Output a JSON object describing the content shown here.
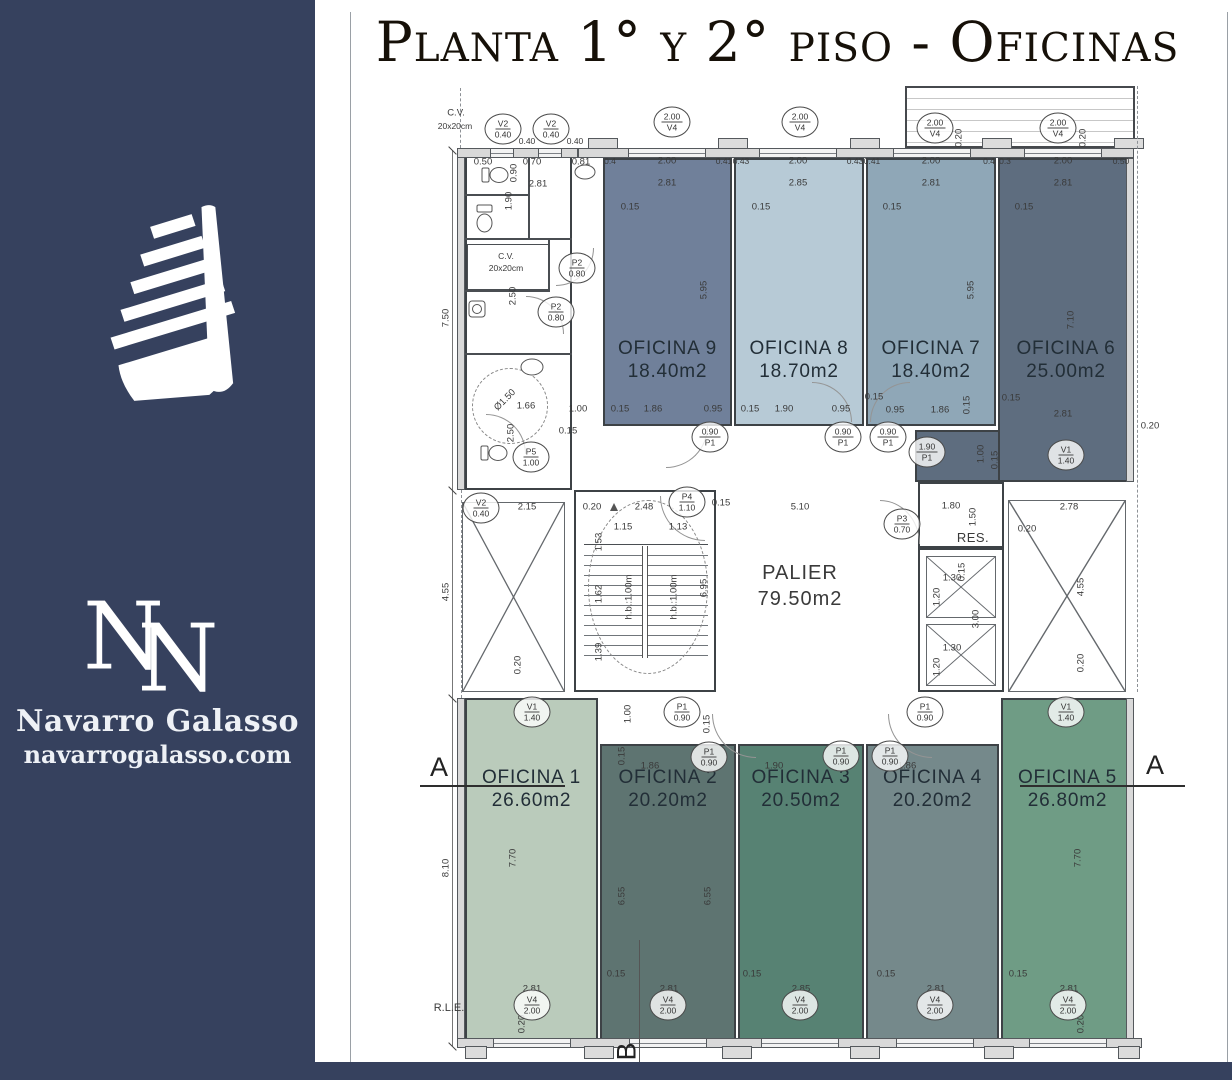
{
  "sidebar": {
    "brand": "Navarro Galasso",
    "site": "navarrogalasso.com",
    "monogram_n1": "N",
    "monogram_n2": "N",
    "bg_color": "#36415e"
  },
  "title": "Planta 1° y 2° piso - Oficinas",
  "plan": {
    "palier": {
      "name": "PALIER",
      "area": "79.50m2"
    },
    "res_label": "RES.",
    "markers": {
      "a": "A",
      "b": "B"
    },
    "offices": [
      {
        "id": 1,
        "name": "OFICINA 1",
        "area": "26.60m2",
        "color": "#bacbbb"
      },
      {
        "id": 2,
        "name": "OFICINA 2",
        "area": "20.20m2",
        "color": "#5e7471"
      },
      {
        "id": 3,
        "name": "OFICINA 3",
        "area": "20.50m2",
        "color": "#578273"
      },
      {
        "id": 4,
        "name": "OFICINA 4",
        "area": "20.20m2",
        "color": "#75898b"
      },
      {
        "id": 5,
        "name": "OFICINA 5",
        "area": "26.80m2",
        "color": "#6f9c85"
      },
      {
        "id": 6,
        "name": "OFICINA 6",
        "area": "25.00m2",
        "color": "#5e6d7f"
      },
      {
        "id": 7,
        "name": "OFICINA 7",
        "area": "18.40m2",
        "color": "#8fa7b7"
      },
      {
        "id": 8,
        "name": "OFICINA 8",
        "area": "18.70m2",
        "color": "#b7cad6"
      },
      {
        "id": 9,
        "name": "OFICINA 9",
        "area": "18.40m2",
        "color": "#70809a"
      }
    ],
    "tags": [
      {
        "a": "V2",
        "b": "0.40",
        "x": 503,
        "y": 129
      },
      {
        "a": "V2",
        "b": "0.40",
        "x": 551,
        "y": 129
      },
      {
        "a": "2.00",
        "b": "V4",
        "x": 672,
        "y": 122
      },
      {
        "a": "2.00",
        "b": "V4",
        "x": 800,
        "y": 122
      },
      {
        "a": "2.00",
        "b": "V4",
        "x": 935,
        "y": 128
      },
      {
        "a": "2.00",
        "b": "V4",
        "x": 1058,
        "y": 128
      },
      {
        "a": "P2",
        "b": "0.80",
        "x": 577,
        "y": 268
      },
      {
        "a": "P2",
        "b": "0.80",
        "x": 556,
        "y": 312
      },
      {
        "a": "P5",
        "b": "1.00",
        "x": 531,
        "y": 457
      },
      {
        "a": "0.90",
        "b": "P1",
        "x": 710,
        "y": 437
      },
      {
        "a": "0.90",
        "b": "P1",
        "x": 843,
        "y": 437
      },
      {
        "a": "0.90",
        "b": "P1",
        "x": 888,
        "y": 437
      },
      {
        "a": "1.90",
        "b": "P1",
        "x": 927,
        "y": 452
      },
      {
        "a": "P4",
        "b": "1.10",
        "x": 687,
        "y": 502
      },
      {
        "a": "P3",
        "b": "0.70",
        "x": 902,
        "y": 524
      },
      {
        "a": "V2",
        "b": "0.40",
        "x": 481,
        "y": 508
      },
      {
        "a": "V1",
        "b": "1.40",
        "x": 1066,
        "y": 455
      },
      {
        "a": "V1",
        "b": "1.40",
        "x": 532,
        "y": 712
      },
      {
        "a": "P1",
        "b": "0.90",
        "x": 682,
        "y": 712
      },
      {
        "a": "P1",
        "b": "0.90",
        "x": 709,
        "y": 757
      },
      {
        "a": "P1",
        "b": "0.90",
        "x": 841,
        "y": 756
      },
      {
        "a": "P1",
        "b": "0.90",
        "x": 890,
        "y": 756
      },
      {
        "a": "P1",
        "b": "0.90",
        "x": 925,
        "y": 712
      },
      {
        "a": "V1",
        "b": "1.40",
        "x": 1066,
        "y": 712
      },
      {
        "a": "V4",
        "b": "2.00",
        "x": 532,
        "y": 1005
      },
      {
        "a": "V4",
        "b": "2.00",
        "x": 668,
        "y": 1005
      },
      {
        "a": "V4",
        "b": "2.00",
        "x": 800,
        "y": 1005
      },
      {
        "a": "V4",
        "b": "2.00",
        "x": 935,
        "y": 1005
      },
      {
        "a": "V4",
        "b": "2.00",
        "x": 1068,
        "y": 1005
      }
    ],
    "annotations": [
      {
        "t": "C.V.",
        "x": 456,
        "y": 113
      },
      {
        "t": "20x20cm",
        "x": 455,
        "y": 126,
        "s": 8.5
      },
      {
        "t": "0.40",
        "x": 527,
        "y": 141,
        "s": 8.5
      },
      {
        "t": "0.40",
        "x": 575,
        "y": 141,
        "s": 8.5
      },
      {
        "t": "0.50",
        "x": 483,
        "y": 162
      },
      {
        "t": "0.90",
        "x": 514,
        "y": 173,
        "r": 90
      },
      {
        "t": "0.70",
        "x": 532,
        "y": 162
      },
      {
        "t": "0.81",
        "x": 581,
        "y": 162
      },
      {
        "t": "2.81",
        "x": 538,
        "y": 184
      },
      {
        "t": "1.90",
        "x": 509,
        "y": 201,
        "r": 90
      },
      {
        "t": "C.V.",
        "x": 506,
        "y": 256,
        "s": 8.5
      },
      {
        "t": "20x20cm",
        "x": 506,
        "y": 268,
        "s": 8.5
      },
      {
        "t": "2.50",
        "x": 513,
        "y": 296,
        "r": 90
      },
      {
        "t": "Ø1.50",
        "x": 505,
        "y": 400,
        "r": 45
      },
      {
        "t": "1.66",
        "x": 526,
        "y": 406
      },
      {
        "t": "2.50",
        "x": 511,
        "y": 433,
        "r": 90
      },
      {
        "t": "1.00",
        "x": 578,
        "y": 409
      },
      {
        "t": "0.15",
        "x": 568,
        "y": 431
      },
      {
        "t": "7.50",
        "x": 446,
        "y": 318,
        "r": 90
      },
      {
        "t": "4.55",
        "x": 446,
        "y": 592,
        "r": 90
      },
      {
        "t": "8.10",
        "x": 446,
        "y": 868,
        "r": 90
      },
      {
        "t": "R.L.E.",
        "x": 449,
        "y": 1008,
        "s": 11
      },
      {
        "t": "0.4",
        "x": 610,
        "y": 161,
        "s": 8.5
      },
      {
        "t": "2.00",
        "x": 667,
        "y": 161
      },
      {
        "t": "0.41",
        "x": 724,
        "y": 161,
        "s": 8.5
      },
      {
        "t": "2.81",
        "x": 667,
        "y": 183
      },
      {
        "t": "0.15",
        "x": 630,
        "y": 207
      },
      {
        "t": "5.95",
        "x": 704,
        "y": 290,
        "r": 90
      },
      {
        "t": "0.15",
        "x": 620,
        "y": 409
      },
      {
        "t": "1.86",
        "x": 653,
        "y": 409
      },
      {
        "t": "0.95",
        "x": 713,
        "y": 409
      },
      {
        "t": "0.43",
        "x": 741,
        "y": 161,
        "s": 8.5
      },
      {
        "t": "2.00",
        "x": 798,
        "y": 161
      },
      {
        "t": "0.43",
        "x": 855,
        "y": 161,
        "s": 8.5
      },
      {
        "t": "2.85",
        "x": 798,
        "y": 183
      },
      {
        "t": "0.15",
        "x": 761,
        "y": 207
      },
      {
        "t": "0.15",
        "x": 750,
        "y": 409
      },
      {
        "t": "1.90",
        "x": 784,
        "y": 409
      },
      {
        "t": "0.95",
        "x": 841,
        "y": 409
      },
      {
        "t": "0.41",
        "x": 872,
        "y": 161,
        "s": 8.5
      },
      {
        "t": "2.00",
        "x": 931,
        "y": 161
      },
      {
        "t": "0.4",
        "x": 989,
        "y": 161,
        "s": 8.5
      },
      {
        "t": "2.81",
        "x": 931,
        "y": 183
      },
      {
        "t": "0.15",
        "x": 892,
        "y": 207
      },
      {
        "t": "5.95",
        "x": 971,
        "y": 290,
        "r": 90
      },
      {
        "t": "0.15",
        "x": 874,
        "y": 397
      },
      {
        "t": "0.95",
        "x": 895,
        "y": 410
      },
      {
        "t": "1.86",
        "x": 940,
        "y": 410
      },
      {
        "t": "0.15",
        "x": 967,
        "y": 405,
        "r": 90
      },
      {
        "t": "0.3",
        "x": 1005,
        "y": 161,
        "s": 8.5
      },
      {
        "t": "2.00",
        "x": 1063,
        "y": 161
      },
      {
        "t": "0.50",
        "x": 1121,
        "y": 161,
        "s": 8.5
      },
      {
        "t": "2.81",
        "x": 1063,
        "y": 183
      },
      {
        "t": "0.15",
        "x": 1024,
        "y": 207
      },
      {
        "t": "7.10",
        "x": 1071,
        "y": 320,
        "r": 90
      },
      {
        "t": "0.15",
        "x": 1011,
        "y": 398
      },
      {
        "t": "2.81",
        "x": 1063,
        "y": 414
      },
      {
        "t": "0.20",
        "x": 1150,
        "y": 426
      },
      {
        "t": "1.00",
        "x": 981,
        "y": 454,
        "r": 90
      },
      {
        "t": "0.15",
        "x": 995,
        "y": 460,
        "r": 90
      },
      {
        "t": "0.20",
        "x": 959,
        "y": 138,
        "r": 90
      },
      {
        "t": "0.20",
        "x": 1083,
        "y": 138,
        "r": 90
      },
      {
        "t": "2.15",
        "x": 527,
        "y": 507
      },
      {
        "t": "0.20",
        "x": 592,
        "y": 507
      },
      {
        "t": "2.48",
        "x": 644,
        "y": 507
      },
      {
        "t": "0.15",
        "x": 721,
        "y": 503
      },
      {
        "t": "5.10",
        "x": 800,
        "y": 507
      },
      {
        "t": "1.15",
        "x": 623,
        "y": 527
      },
      {
        "t": "1.13",
        "x": 678,
        "y": 527
      },
      {
        "t": "1.53",
        "x": 599,
        "y": 542,
        "r": 90
      },
      {
        "t": "1.62",
        "x": 599,
        "y": 594,
        "r": 90
      },
      {
        "t": "1.39",
        "x": 599,
        "y": 652,
        "r": 90
      },
      {
        "t": "0.20",
        "x": 518,
        "y": 665,
        "r": 90
      },
      {
        "t": "6.95",
        "x": 704,
        "y": 588,
        "r": 90
      },
      {
        "t": "h.b.:1.00m",
        "x": 629,
        "y": 597,
        "r": 90
      },
      {
        "t": "h.b.:1.00m",
        "x": 674,
        "y": 597,
        "r": 90
      },
      {
        "t": "1.80",
        "x": 951,
        "y": 506
      },
      {
        "t": "1.50",
        "x": 973,
        "y": 517,
        "r": 90
      },
      {
        "t": "1.30",
        "x": 952,
        "y": 578
      },
      {
        "t": "1.20",
        "x": 937,
        "y": 597,
        "r": 90
      },
      {
        "t": "1.30",
        "x": 952,
        "y": 648
      },
      {
        "t": "1.20",
        "x": 937,
        "y": 667,
        "r": 90
      },
      {
        "t": "3.00",
        "x": 976,
        "y": 619,
        "r": 90
      },
      {
        "t": "0.15",
        "x": 962,
        "y": 572,
        "r": 90
      },
      {
        "t": "2.78",
        "x": 1069,
        "y": 507
      },
      {
        "t": "0.20",
        "x": 1027,
        "y": 529
      },
      {
        "t": "4.55",
        "x": 1081,
        "y": 587,
        "r": 90
      },
      {
        "t": "0.20",
        "x": 1081,
        "y": 663,
        "r": 90
      },
      {
        "t": "1.00",
        "x": 628,
        "y": 714,
        "r": 90
      },
      {
        "t": "0.15",
        "x": 707,
        "y": 724,
        "r": 90
      },
      {
        "t": "7.70",
        "x": 513,
        "y": 858,
        "r": 90
      },
      {
        "t": "2.81",
        "x": 532,
        "y": 989
      },
      {
        "t": "0.20",
        "x": 522,
        "y": 1024,
        "r": 90
      },
      {
        "t": "0.15",
        "x": 622,
        "y": 756,
        "r": 90
      },
      {
        "t": "1.86",
        "x": 650,
        "y": 766
      },
      {
        "t": "6.55",
        "x": 622,
        "y": 896,
        "r": 90
      },
      {
        "t": "6.55",
        "x": 708,
        "y": 896,
        "r": 90
      },
      {
        "t": "0.15",
        "x": 616,
        "y": 974
      },
      {
        "t": "2.81",
        "x": 669,
        "y": 989
      },
      {
        "t": "1.90",
        "x": 774,
        "y": 766
      },
      {
        "t": "0.15",
        "x": 752,
        "y": 974
      },
      {
        "t": "2.85",
        "x": 801,
        "y": 989
      },
      {
        "t": "1.86",
        "x": 907,
        "y": 766
      },
      {
        "t": "0.15",
        "x": 886,
        "y": 974
      },
      {
        "t": "2.81",
        "x": 936,
        "y": 989
      },
      {
        "t": "7.70",
        "x": 1078,
        "y": 858,
        "r": 90
      },
      {
        "t": "0.15",
        "x": 1018,
        "y": 974
      },
      {
        "t": "2.81",
        "x": 1069,
        "y": 989
      },
      {
        "t": "0.20",
        "x": 1081,
        "y": 1024,
        "r": 90
      }
    ]
  }
}
